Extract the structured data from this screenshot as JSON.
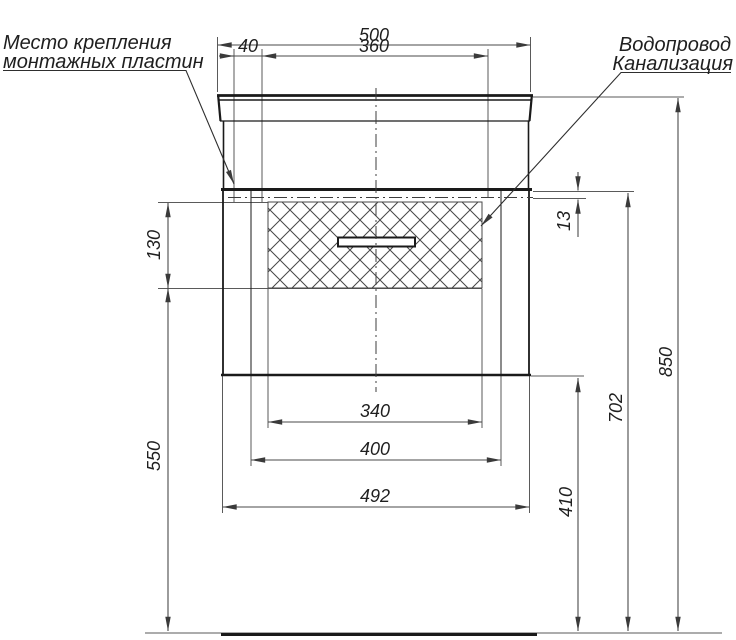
{
  "drawing": {
    "type": "installation-drawing",
    "subject": "bathroom vanity cabinet with washbasin, front view",
    "notes": {
      "mounting": {
        "line1": "Место крепления",
        "line2": "монтажных пластин"
      },
      "plumbing": {
        "line1": "Водопровод",
        "line2": "Канализация"
      }
    },
    "dims": {
      "total_width": "500",
      "plate_offset": "40",
      "plate_spacing": "360",
      "plate_zone_height": "130",
      "left_height": "550",
      "basin_cutout_width": "340",
      "drawer_width": "400",
      "cabinet_width": "492",
      "plate_top_inset": "13",
      "bottom_clearance": "410",
      "worktop_height": "702",
      "total_height": "850"
    },
    "colors": {
      "object_line": "#1a1a1a",
      "thin_line": "#5a5a5a",
      "text": "#1f1f1f",
      "background": "#ffffff"
    }
  }
}
